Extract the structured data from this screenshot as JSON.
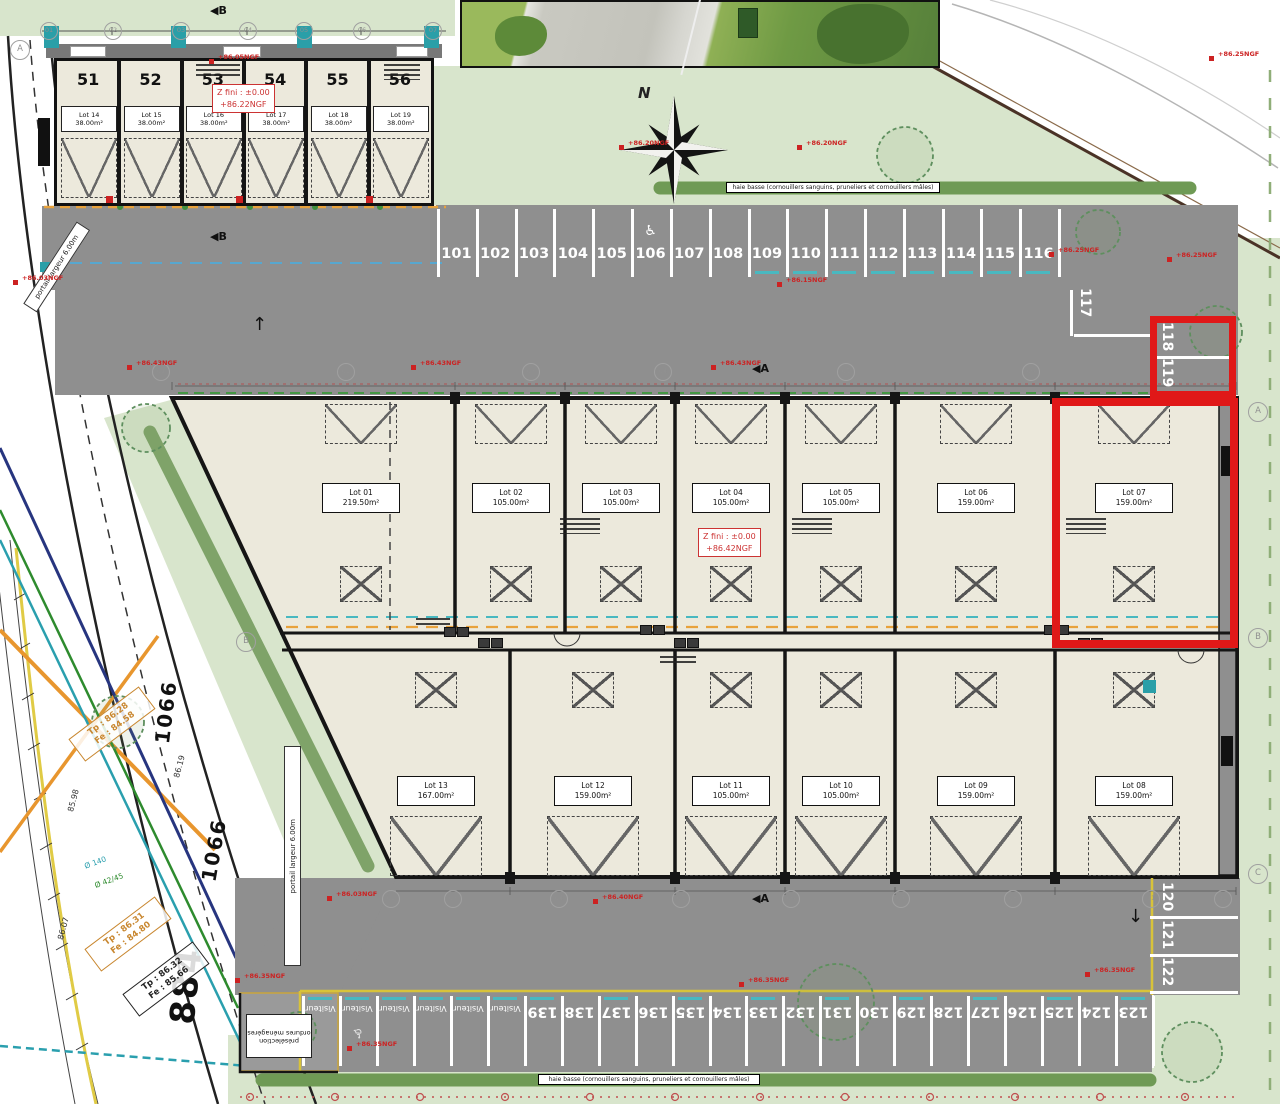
{
  "plan": {
    "banner_hedge": "haie basse (cornouillers sanguins, pruneliers et cornouillers mâles)",
    "compass_label": "N",
    "level_markers": [
      {
        "line1": "Z fini : ±0.00",
        "line2": "+86.22NGF"
      },
      {
        "line1": "Z fini : ±0.00",
        "line2": "+86.42NGF"
      }
    ],
    "gate_label": "portail largeur 6.00m",
    "waste_label": "présélection ordures ménagères",
    "road_labels": [
      {
        "text": "1066",
        "x": 134,
        "y": 700,
        "rot": -83,
        "size": 20
      },
      {
        "text": "1066",
        "x": 182,
        "y": 838,
        "rot": -80,
        "size": 20
      },
      {
        "text": "884",
        "x": 148,
        "y": 966,
        "rot": -84,
        "size": 34
      }
    ],
    "elevation_labels": [
      {
        "text": "85.98",
        "x": 62,
        "y": 796,
        "rot": -75
      },
      {
        "text": "86.19",
        "x": 168,
        "y": 762,
        "rot": -75
      },
      {
        "text": "86.07",
        "x": 52,
        "y": 924,
        "rot": -75
      }
    ],
    "pipe_labels": [
      {
        "text": "Ø 140",
        "x": 84,
        "y": 858,
        "rot": -20,
        "color": "#2a9fae"
      },
      {
        "text": "Ø 42/45",
        "x": 94,
        "y": 876,
        "rot": -20,
        "color": "#2e8b2e"
      }
    ],
    "survey_diamonds": [
      {
        "top": "Tp : 86.28",
        "bottom": "Fe : 84.58",
        "color": "#c8862e",
        "x": 108,
        "y": 728
      },
      {
        "top": "Tp : 86.31",
        "bottom": "Fe : 84.80",
        "color": "#c8862e",
        "x": 124,
        "y": 938
      },
      {
        "top": "Tp : 86.32",
        "bottom": "Fe : 85.66",
        "color": "#222222",
        "x": 162,
        "y": 983
      }
    ],
    "garages": [
      {
        "door": "51",
        "lot": "Lot 14",
        "area": "38.00m²"
      },
      {
        "door": "52",
        "lot": "Lot 15",
        "area": "38.00m²"
      },
      {
        "door": "53",
        "lot": "Lot 16",
        "area": "38.00m²"
      },
      {
        "door": "54",
        "lot": "Lot 17",
        "area": "38.00m²"
      },
      {
        "door": "55",
        "lot": "Lot 18",
        "area": "38.00m²"
      },
      {
        "door": "56",
        "lot": "Lot 19",
        "area": "38.00m²"
      }
    ],
    "lots_north": [
      {
        "name": "Lot 01",
        "area": "219.50m²"
      },
      {
        "name": "Lot 02",
        "area": "105.00m²"
      },
      {
        "name": "Lot 03",
        "area": "105.00m²"
      },
      {
        "name": "Lot 04",
        "area": "105.00m²"
      },
      {
        "name": "Lot 05",
        "area": "105.00m²"
      },
      {
        "name": "Lot 06",
        "area": "159.00m²"
      },
      {
        "name": "Lot 07",
        "area": "159.00m²"
      }
    ],
    "lots_south": [
      {
        "name": "Lot 13",
        "area": "167.00m²"
      },
      {
        "name": "Lot 12",
        "area": "159.00m²"
      },
      {
        "name": "Lot 11",
        "area": "105.00m²"
      },
      {
        "name": "Lot 10",
        "area": "105.00m²"
      },
      {
        "name": "Lot 09",
        "area": "159.00m²"
      },
      {
        "name": "Lot 08",
        "area": "159.00m²"
      }
    ],
    "parking": {
      "north_row": [
        "101",
        "102",
        "103",
        "104",
        "105",
        "106",
        "107",
        "108",
        "109",
        "110",
        "111",
        "112",
        "113",
        "114",
        "115",
        "116"
      ],
      "accessible_stall": "106",
      "east_upper": [
        "117",
        "118",
        "119"
      ],
      "east_lower": [
        "120",
        "121",
        "122"
      ],
      "south_row": [
        "139",
        "138",
        "137",
        "136",
        "135",
        "134",
        "133",
        "132",
        "131",
        "130",
        "129",
        "128",
        "127",
        "126",
        "125",
        "124",
        "123"
      ],
      "visitor_label": "Visiteur",
      "visitor_count": 6
    },
    "highlighted": {
      "stalls": [
        "118",
        "119"
      ],
      "lot": "Lot 07"
    },
    "icons": {
      "accessible": "♿",
      "arrow_up": "↑",
      "arrow_down": "↓",
      "section_marker": "◀"
    },
    "ngf_annotations": [
      {
        "x": 218,
        "y": 57,
        "label": "+86.05NGF"
      },
      {
        "x": 628,
        "y": 143,
        "label": "+86.20NGF"
      },
      {
        "x": 806,
        "y": 143,
        "label": "+86.20NGF"
      },
      {
        "x": 1058,
        "y": 250,
        "label": "+86.25NGF"
      },
      {
        "x": 1176,
        "y": 255,
        "label": "+86.25NGF"
      },
      {
        "x": 22,
        "y": 278,
        "label": "+86.03NGF"
      },
      {
        "x": 136,
        "y": 363,
        "label": "+86.43NGF"
      },
      {
        "x": 420,
        "y": 363,
        "label": "+86.43NGF"
      },
      {
        "x": 720,
        "y": 363,
        "label": "+86.43NGF"
      },
      {
        "x": 1218,
        "y": 54,
        "label": "+86.25NGF"
      },
      {
        "x": 786,
        "y": 280,
        "label": "+86.15NGF"
      },
      {
        "x": 336,
        "y": 894,
        "label": "+86.03NGF"
      },
      {
        "x": 602,
        "y": 897,
        "label": "+86.40NGF"
      },
      {
        "x": 244,
        "y": 976,
        "label": "+86.35NGF"
      },
      {
        "x": 356,
        "y": 1044,
        "label": "+86.35NGF"
      },
      {
        "x": 748,
        "y": 980,
        "label": "+86.35NGF"
      },
      {
        "x": 1094,
        "y": 970,
        "label": "+86.35NGF"
      }
    ],
    "grid": {
      "garage_cols": [
        "01",
        "02",
        "03",
        "04",
        "05",
        "06",
        "07"
      ],
      "north_cols": [
        "01",
        "02",
        "03",
        "04",
        "05",
        "06"
      ],
      "south_cols": [
        "02",
        "03",
        "04",
        "05",
        "06",
        "07",
        "08",
        "11",
        "12"
      ],
      "letter_topleft": "A",
      "letter_left_b": "B",
      "row_letters_right": [
        "A",
        "B",
        "C"
      ],
      "section_markers": [
        "B",
        "B",
        "A",
        "A"
      ]
    },
    "colors": {
      "highlight": "#e01818",
      "asphalt": "#8f8f8f",
      "building": "#ece9dc",
      "green": "#d8e5cc",
      "annotation": "#cc2222",
      "teal": "#2a9fa8",
      "orange": "#e8962e"
    }
  }
}
